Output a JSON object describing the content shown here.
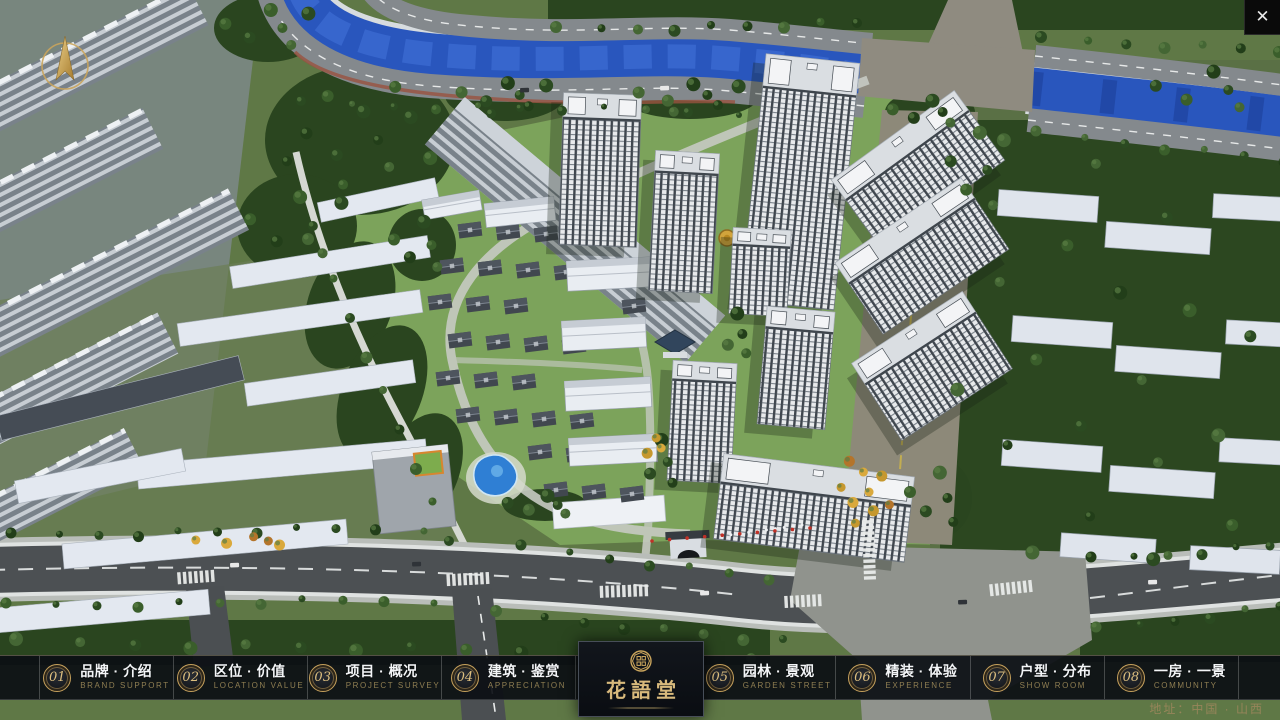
{
  "window": {
    "close_icon_glyph": "✕"
  },
  "nav": {
    "items": [
      {
        "number": "01",
        "label": "品牌 · 介绍",
        "sublabel": "BRAND SUPPORT"
      },
      {
        "number": "02",
        "label": "区位 · 价值",
        "sublabel": "LOCATION VALUE"
      },
      {
        "number": "03",
        "label": "项目 · 概况",
        "sublabel": "PROJECT SURVEY"
      },
      {
        "number": "04",
        "label": "建筑 · 鉴赏",
        "sublabel": "APPRECIATION"
      },
      {
        "number": "05",
        "label": "园林 · 景观",
        "sublabel": "GARDEN STREET"
      },
      {
        "number": "06",
        "label": "精装 · 体验",
        "sublabel": "EXPERIENCE"
      },
      {
        "number": "07",
        "label": "户型 · 分布",
        "sublabel": "SHOW ROOM"
      },
      {
        "number": "08",
        "label": "一房 · 一景",
        "sublabel": "COMMUNITY"
      }
    ]
  },
  "brand": {
    "name": "花語堂",
    "seal_icon": "circular-seal-emblem"
  },
  "footer": {
    "address": "地址：中国 · 山西"
  },
  "icons": {
    "compass": "north-arrow-icon",
    "close": "close-icon"
  },
  "colors": {
    "gold": "#c8a566",
    "gold_dim": "#8f7e52",
    "bar_bg": "#0b0e13",
    "river_blue": "#2956bd",
    "tree_green": "#2b4a21",
    "road_gray": "#4c5053"
  }
}
